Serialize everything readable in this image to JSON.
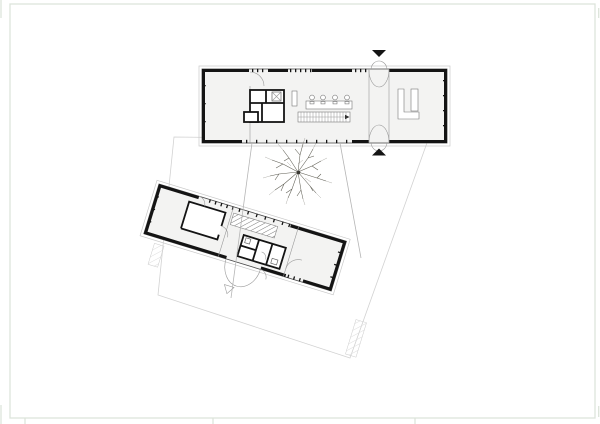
{
  "sheet": {
    "width_px": 600,
    "height_px": 424,
    "border": "thin inner border with registration tick marks at sheet edges",
    "visible_text": "none"
  },
  "palette": {
    "paper": "#ffffff",
    "frame": "#dde4db",
    "ink": "#141414",
    "floor": "#f3f3f2",
    "faint": "#c9c9c9",
    "boundary": "#d2d2d2",
    "path": "#b5b5b5",
    "furniture": "#777777",
    "door": "#9a9a9a",
    "tree": "#4e4c41"
  },
  "plan": {
    "type": "architectural site / floor plan, two buildings around a courtyard",
    "north_building": {
      "orientation_deg": 0,
      "entrance_markers": 2,
      "chairs_at_table": 4,
      "features": [
        "open room west",
        "service core with x-marked shaft",
        "counter",
        "meeting table with chairs",
        "staircase with direction arrow",
        "glazed entrance corridor with double swing doors north and south",
        "kitchen room east"
      ]
    },
    "south_building": {
      "orientation_deg": 17,
      "features": [
        "open room west with inner cabin",
        "hatched staircase",
        "wc core",
        "glazed courtyard wall",
        "open room east",
        "outward double entrance doors",
        "small triangle entrance marker"
      ]
    },
    "site": {
      "boundary_shape": "faint quadrilateral plot line",
      "courtyard_path": "splayed walkway linking the two buildings",
      "tree_count": 1,
      "tree_style": "hand-drawn branching crown",
      "hatched_ramps": 2
    }
  }
}
